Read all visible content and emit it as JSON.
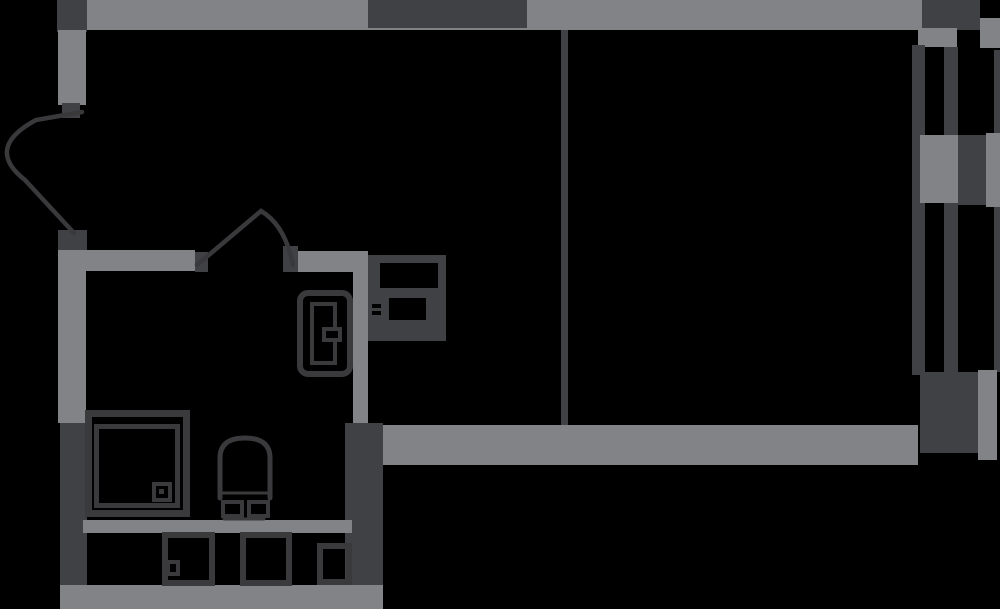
{
  "canvas": {
    "width": 1000,
    "height": 609,
    "background": "#000000"
  },
  "palette": {
    "wall_gray": "#828387",
    "wall_dark": "#404144",
    "fixture_stroke": "#3a3a3d",
    "door_stroke": "#39393c",
    "cutout_black": "#000000"
  },
  "plan": {
    "title": "studio-apartment-floor-plan",
    "elements": [
      {
        "name": "top-wall",
        "type": "rect",
        "x": 86,
        "y": 0,
        "w": 836,
        "h": 30,
        "fill": "gray"
      },
      {
        "name": "top-wall-dark-segment",
        "type": "rect",
        "x": 368,
        "y": 0,
        "w": 159,
        "h": 28,
        "fill": "dark"
      },
      {
        "name": "top-left-corner-block",
        "type": "rect",
        "x": 57,
        "y": 0,
        "w": 30,
        "h": 32,
        "fill": "dark"
      },
      {
        "name": "left-wall-upper",
        "type": "rect",
        "x": 58,
        "y": 30,
        "w": 28,
        "h": 75,
        "fill": "gray"
      },
      {
        "name": "entry-door-top-jamb",
        "type": "rect",
        "x": 62,
        "y": 103,
        "w": 18,
        "h": 15,
        "fill": "dark"
      },
      {
        "name": "entry-door-bottom-jamb",
        "type": "rect",
        "x": 58,
        "y": 230,
        "w": 29,
        "h": 20,
        "fill": "dark"
      },
      {
        "name": "left-wall-middle",
        "type": "rect",
        "x": 58,
        "y": 250,
        "w": 28,
        "h": 173,
        "fill": "gray"
      },
      {
        "name": "left-wall-lower-dark",
        "type": "rect",
        "x": 60,
        "y": 423,
        "w": 27,
        "h": 162,
        "fill": "dark"
      },
      {
        "name": "bottom-wall",
        "type": "rect",
        "x": 60,
        "y": 585,
        "w": 323,
        "h": 24,
        "fill": "gray"
      },
      {
        "name": "bath-wall-top-left",
        "type": "rect",
        "x": 83,
        "y": 250,
        "w": 112,
        "h": 21,
        "fill": "gray"
      },
      {
        "name": "bath-door-left-jamb",
        "type": "rect",
        "x": 195,
        "y": 252,
        "w": 13,
        "h": 20,
        "fill": "dark"
      },
      {
        "name": "bath-door-right-jamb",
        "type": "rect",
        "x": 283,
        "y": 246,
        "w": 15,
        "h": 26,
        "fill": "dark"
      },
      {
        "name": "bath-wall-top-right",
        "type": "rect",
        "x": 298,
        "y": 251,
        "w": 70,
        "h": 21,
        "fill": "gray"
      },
      {
        "name": "hall-wall-vertical",
        "type": "rect",
        "x": 353,
        "y": 253,
        "w": 15,
        "h": 170,
        "fill": "gray"
      },
      {
        "name": "bath-wall-right-dark",
        "type": "rect",
        "x": 345,
        "y": 423,
        "w": 38,
        "h": 162,
        "fill": "dark"
      },
      {
        "name": "bath-wall-middle-band",
        "type": "rect",
        "x": 83,
        "y": 520,
        "w": 269,
        "h": 13,
        "fill": "gray"
      },
      {
        "name": "living-wall-bottom",
        "type": "rect",
        "x": 383,
        "y": 425,
        "w": 535,
        "h": 40,
        "fill": "gray"
      },
      {
        "name": "room-partition-line",
        "type": "rect",
        "x": 561,
        "y": 30,
        "w": 7,
        "h": 395,
        "fill": "dark"
      },
      {
        "name": "window-top-block",
        "type": "rect",
        "x": 922,
        "y": 0,
        "w": 58,
        "h": 30,
        "fill": "dark"
      },
      {
        "name": "window-top-pier-right",
        "type": "rect",
        "x": 980,
        "y": 18,
        "w": 20,
        "h": 30,
        "fill": "gray"
      },
      {
        "name": "window-pier-top",
        "type": "rect",
        "x": 918,
        "y": 28,
        "w": 39,
        "h": 19,
        "fill": "gray"
      },
      {
        "name": "window-frame-inner",
        "type": "rect",
        "x": 912,
        "y": 45,
        "w": 13,
        "h": 330,
        "fill": "dark"
      },
      {
        "name": "window-frame-middle",
        "type": "rect",
        "x": 944,
        "y": 47,
        "w": 14,
        "h": 328,
        "fill": "dark"
      },
      {
        "name": "window-frame-outer",
        "type": "rect",
        "x": 994,
        "y": 50,
        "w": 6,
        "h": 322,
        "fill": "dark"
      },
      {
        "name": "window-pier-mid-gray",
        "type": "rect",
        "x": 920,
        "y": 135,
        "w": 38,
        "h": 68,
        "fill": "gray"
      },
      {
        "name": "window-pier-mid-dark",
        "type": "rect",
        "x": 958,
        "y": 135,
        "w": 28,
        "h": 70,
        "fill": "dark"
      },
      {
        "name": "window-pier-mid-right",
        "type": "rect",
        "x": 986,
        "y": 133,
        "w": 14,
        "h": 74,
        "fill": "gray"
      },
      {
        "name": "window-bottom-block",
        "type": "rect",
        "x": 920,
        "y": 372,
        "w": 63,
        "h": 81,
        "fill": "dark"
      },
      {
        "name": "window-pier-bottom-right",
        "type": "rect",
        "x": 978,
        "y": 370,
        "w": 19,
        "h": 90,
        "fill": "gray"
      },
      {
        "name": "shower-tray-outer",
        "type": "rect",
        "x": 85,
        "y": 410,
        "w": 105,
        "h": 107,
        "fill": "none",
        "stroke": "fixture",
        "sw": 7
      },
      {
        "name": "shower-tray-inner",
        "type": "rect",
        "x": 94,
        "y": 424,
        "w": 86,
        "h": 84,
        "fill": "none",
        "stroke": "fixture",
        "sw": 5
      },
      {
        "name": "shower-drain",
        "type": "rect",
        "x": 152,
        "y": 482,
        "w": 20,
        "h": 20,
        "fill": "none",
        "stroke": "fixture",
        "sw": 4
      },
      {
        "name": "shower-drain-dot",
        "type": "rect",
        "x": 159,
        "y": 489,
        "w": 5,
        "h": 5,
        "fill": "fixture"
      },
      {
        "name": "toilet-bowl",
        "type": "path",
        "d": "M 220 498 L 220 458 Q 220 438 245 438 Q 270 438 270 458 L 270 498",
        "stroke": "fixture",
        "sw": 5
      },
      {
        "name": "toilet-seat-line",
        "type": "path",
        "d": "M 222 493 L 268 493",
        "stroke": "fixture",
        "sw": 3
      },
      {
        "name": "toilet-tank-left",
        "type": "rect",
        "x": 221,
        "y": 500,
        "w": 23,
        "h": 18,
        "fill": "none",
        "stroke": "fixture",
        "sw": 4
      },
      {
        "name": "toilet-tank-right",
        "type": "rect",
        "x": 247,
        "y": 500,
        "w": 23,
        "h": 18,
        "fill": "none",
        "stroke": "fixture",
        "sw": 4
      },
      {
        "name": "toilet-base-line",
        "type": "path",
        "d": "M 224 519 L 264 519",
        "stroke": "fixture",
        "sw": 3
      },
      {
        "name": "sink-cabinet-outer",
        "type": "rect",
        "x": 297,
        "y": 290,
        "w": 56,
        "h": 87,
        "fill": "none",
        "stroke": "fixture",
        "sw": 6,
        "r": 8
      },
      {
        "name": "sink-cabinet-inner",
        "type": "rect",
        "x": 310,
        "y": 302,
        "w": 27,
        "h": 63,
        "fill": "none",
        "stroke": "fixture",
        "sw": 4
      },
      {
        "name": "sink-cabinet-notch",
        "type": "rect",
        "x": 322,
        "y": 327,
        "w": 20,
        "h": 15,
        "fill": "black",
        "stroke": "fixture",
        "sw": 4
      },
      {
        "name": "stove-body",
        "type": "rect",
        "x": 368,
        "y": 255,
        "w": 78,
        "h": 86,
        "fill": "dark"
      },
      {
        "name": "stove-cutout-top",
        "type": "rect",
        "x": 380,
        "y": 263,
        "w": 58,
        "h": 25,
        "fill": "black"
      },
      {
        "name": "stove-cutout-mid",
        "type": "rect",
        "x": 389,
        "y": 298,
        "w": 37,
        "h": 22,
        "fill": "black"
      },
      {
        "name": "stove-mark-1",
        "type": "rect",
        "x": 372,
        "y": 304,
        "w": 9,
        "h": 4,
        "fill": "black"
      },
      {
        "name": "stove-mark-2",
        "type": "rect",
        "x": 372,
        "y": 311,
        "w": 9,
        "h": 4,
        "fill": "black"
      },
      {
        "name": "appliance-box-left",
        "type": "rect",
        "x": 162,
        "y": 532,
        "w": 53,
        "h": 54,
        "fill": "none",
        "stroke": "fixture",
        "sw": 6
      },
      {
        "name": "appliance-box-left-mark",
        "type": "rect",
        "x": 166,
        "y": 560,
        "w": 14,
        "h": 16,
        "fill": "none",
        "stroke": "fixture",
        "sw": 4
      },
      {
        "name": "appliance-box-middle",
        "type": "rect",
        "x": 240,
        "y": 532,
        "w": 52,
        "h": 54,
        "fill": "none",
        "stroke": "fixture",
        "sw": 6
      },
      {
        "name": "appliance-box-small",
        "type": "rect",
        "x": 317,
        "y": 543,
        "w": 35,
        "h": 42,
        "fill": "none",
        "stroke": "fixture",
        "sw": 6
      },
      {
        "name": "entry-door-swing",
        "type": "path",
        "d": "M 82 112 L 36 120 Q -16 148 25 180 L 74 233",
        "stroke": "door",
        "sw": 4.5
      },
      {
        "name": "bath-door-swing",
        "type": "path",
        "d": "M 197 265 L 261 211 Q 285 225 293 265",
        "stroke": "door",
        "sw": 4.5
      }
    ]
  }
}
